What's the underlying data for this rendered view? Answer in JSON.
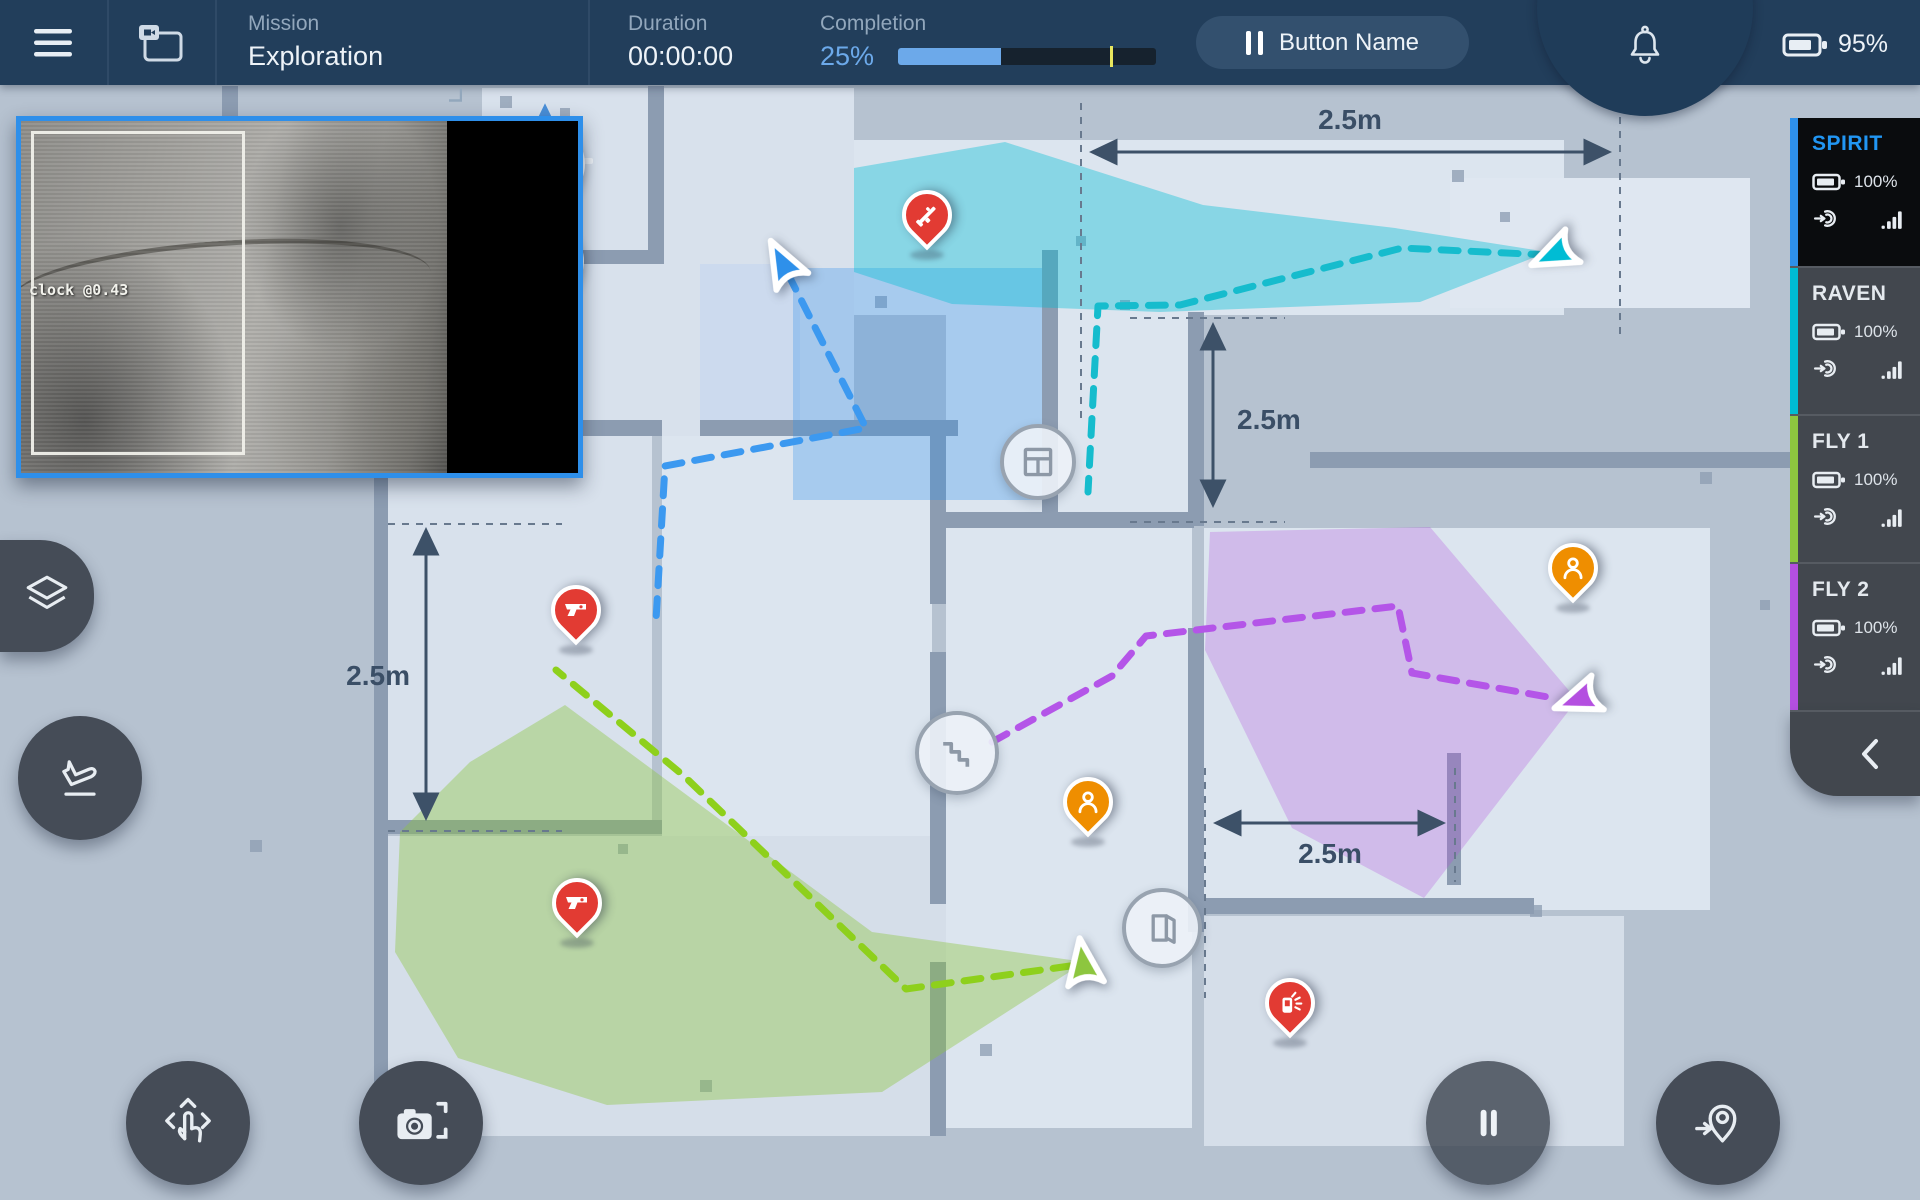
{
  "topbar": {
    "mission_label": "Mission",
    "mission_value": "Exploration",
    "duration_label": "Duration",
    "duration_value": "00:00:00",
    "completion_label": "Completion",
    "completion_value": "25%",
    "completion_progress_pct": 40,
    "completion_marker_pct": 82,
    "action_button_label": "Button Name",
    "battery_value": "95%"
  },
  "video_feed": {
    "detection_label": "clock @0.43",
    "border_color": "#2e8fea"
  },
  "map": {
    "compass_label": "N",
    "dimension_labels": {
      "top": "2.5m",
      "right": "2.5m",
      "left": "2.5m",
      "bottom": "2.5m"
    },
    "poi": {
      "rifle": {
        "type": "rifle-threat",
        "color": "#e23b33"
      },
      "pistol_1": {
        "type": "pistol-threat",
        "color": "#e23b33"
      },
      "pistol_2": {
        "type": "pistol-threat",
        "color": "#e23b33"
      },
      "detonator": {
        "type": "explosive-threat",
        "color": "#e23b33"
      },
      "person_1": {
        "type": "person",
        "color": "#ef8e00"
      },
      "person_2": {
        "type": "person",
        "color": "#ef8e00"
      }
    },
    "map_icons": [
      "window-icon",
      "stairs-icon",
      "door-icon"
    ]
  },
  "robots": [
    {
      "name": "SPIRIT",
      "battery": "100%",
      "color": "#2e90ea",
      "path_color": "#3c99f0",
      "selected": true
    },
    {
      "name": "RAVEN",
      "battery": "100%",
      "color": "#00bcd4",
      "path_color": "#16bccd",
      "selected": false
    },
    {
      "name": "FLY 1",
      "battery": "100%",
      "color": "#8dc63f",
      "path_color": "#8ed01c",
      "selected": false
    },
    {
      "name": "FLY 2",
      "battery": "100%",
      "color": "#b44fe0",
      "path_color": "#b455e8",
      "selected": false
    }
  ],
  "colors": {
    "topbar_bg": "#223e5b",
    "accent_blue": "#6ca9ea",
    "progress_marker_yellow": "#e8e65e",
    "selected_robot_text": "#2196f3",
    "map_background": "#b6c2d0",
    "room_fill": "#dce5ef",
    "wall_fill": "#8c9cb1",
    "dimension_ink": "#3a4e66"
  }
}
